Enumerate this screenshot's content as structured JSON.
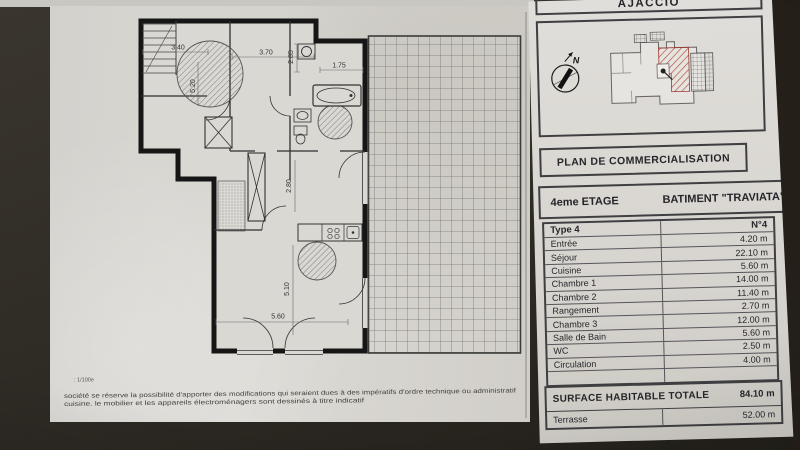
{
  "photo": {
    "background_color": "#2e2a24",
    "paper_color": "#d8d6d1"
  },
  "right_panel": {
    "city": "AJACCIO",
    "site_plan": {
      "north_label": "N"
    },
    "accent_hatch_color": "#b5483a",
    "title": "PLAN DE COMMERCIALISATION",
    "floor": "4eme ETAGE",
    "building": "BATIMENT \"TRAVIATA\"",
    "table": {
      "type_label": "Type 4",
      "unit_label": "N°4",
      "rooms": [
        {
          "name": "Entrée",
          "area": "4.20 m"
        },
        {
          "name": "Séjour",
          "area": "22.10 m"
        },
        {
          "name": "Cuisine",
          "area": "5.60 m"
        },
        {
          "name": "Chambre 1",
          "area": "14.00 m"
        },
        {
          "name": "Chambre 2",
          "area": "11.40 m"
        },
        {
          "name": "Rangement",
          "area": "2.70 m"
        },
        {
          "name": "Chambre 3",
          "area": "12.00 m"
        },
        {
          "name": "Salle de Bain",
          "area": "5.60 m"
        },
        {
          "name": "WC",
          "area": "2.50 m"
        },
        {
          "name": "Circulation",
          "area": "4.00 m"
        }
      ],
      "total_label": "SURFACE HABITABLE TOTALE",
      "total_area": "84.10 m",
      "terrace_label": "Terrasse",
      "terrace_area": "52.00 m"
    }
  },
  "plan": {
    "scale_note": ": 1/100e",
    "disclaimer_line1": "société se réserve la possibilité d'apporter des modifications qui seraient dues à des impératifs d'ordre technique ou administratif",
    "disclaimer_line2": "cuisine. le mobilier et les appareils électroménagers sont dessinés à titre indicatif",
    "dimensions": {
      "top_left": "3.40",
      "top_center": "3.70",
      "top_vertical": "2.85",
      "top_right": "1.75",
      "left_vertical": "5.20",
      "mid_vertical": "2.80",
      "low_vertical": "5.10",
      "bottom": "5.60"
    }
  }
}
